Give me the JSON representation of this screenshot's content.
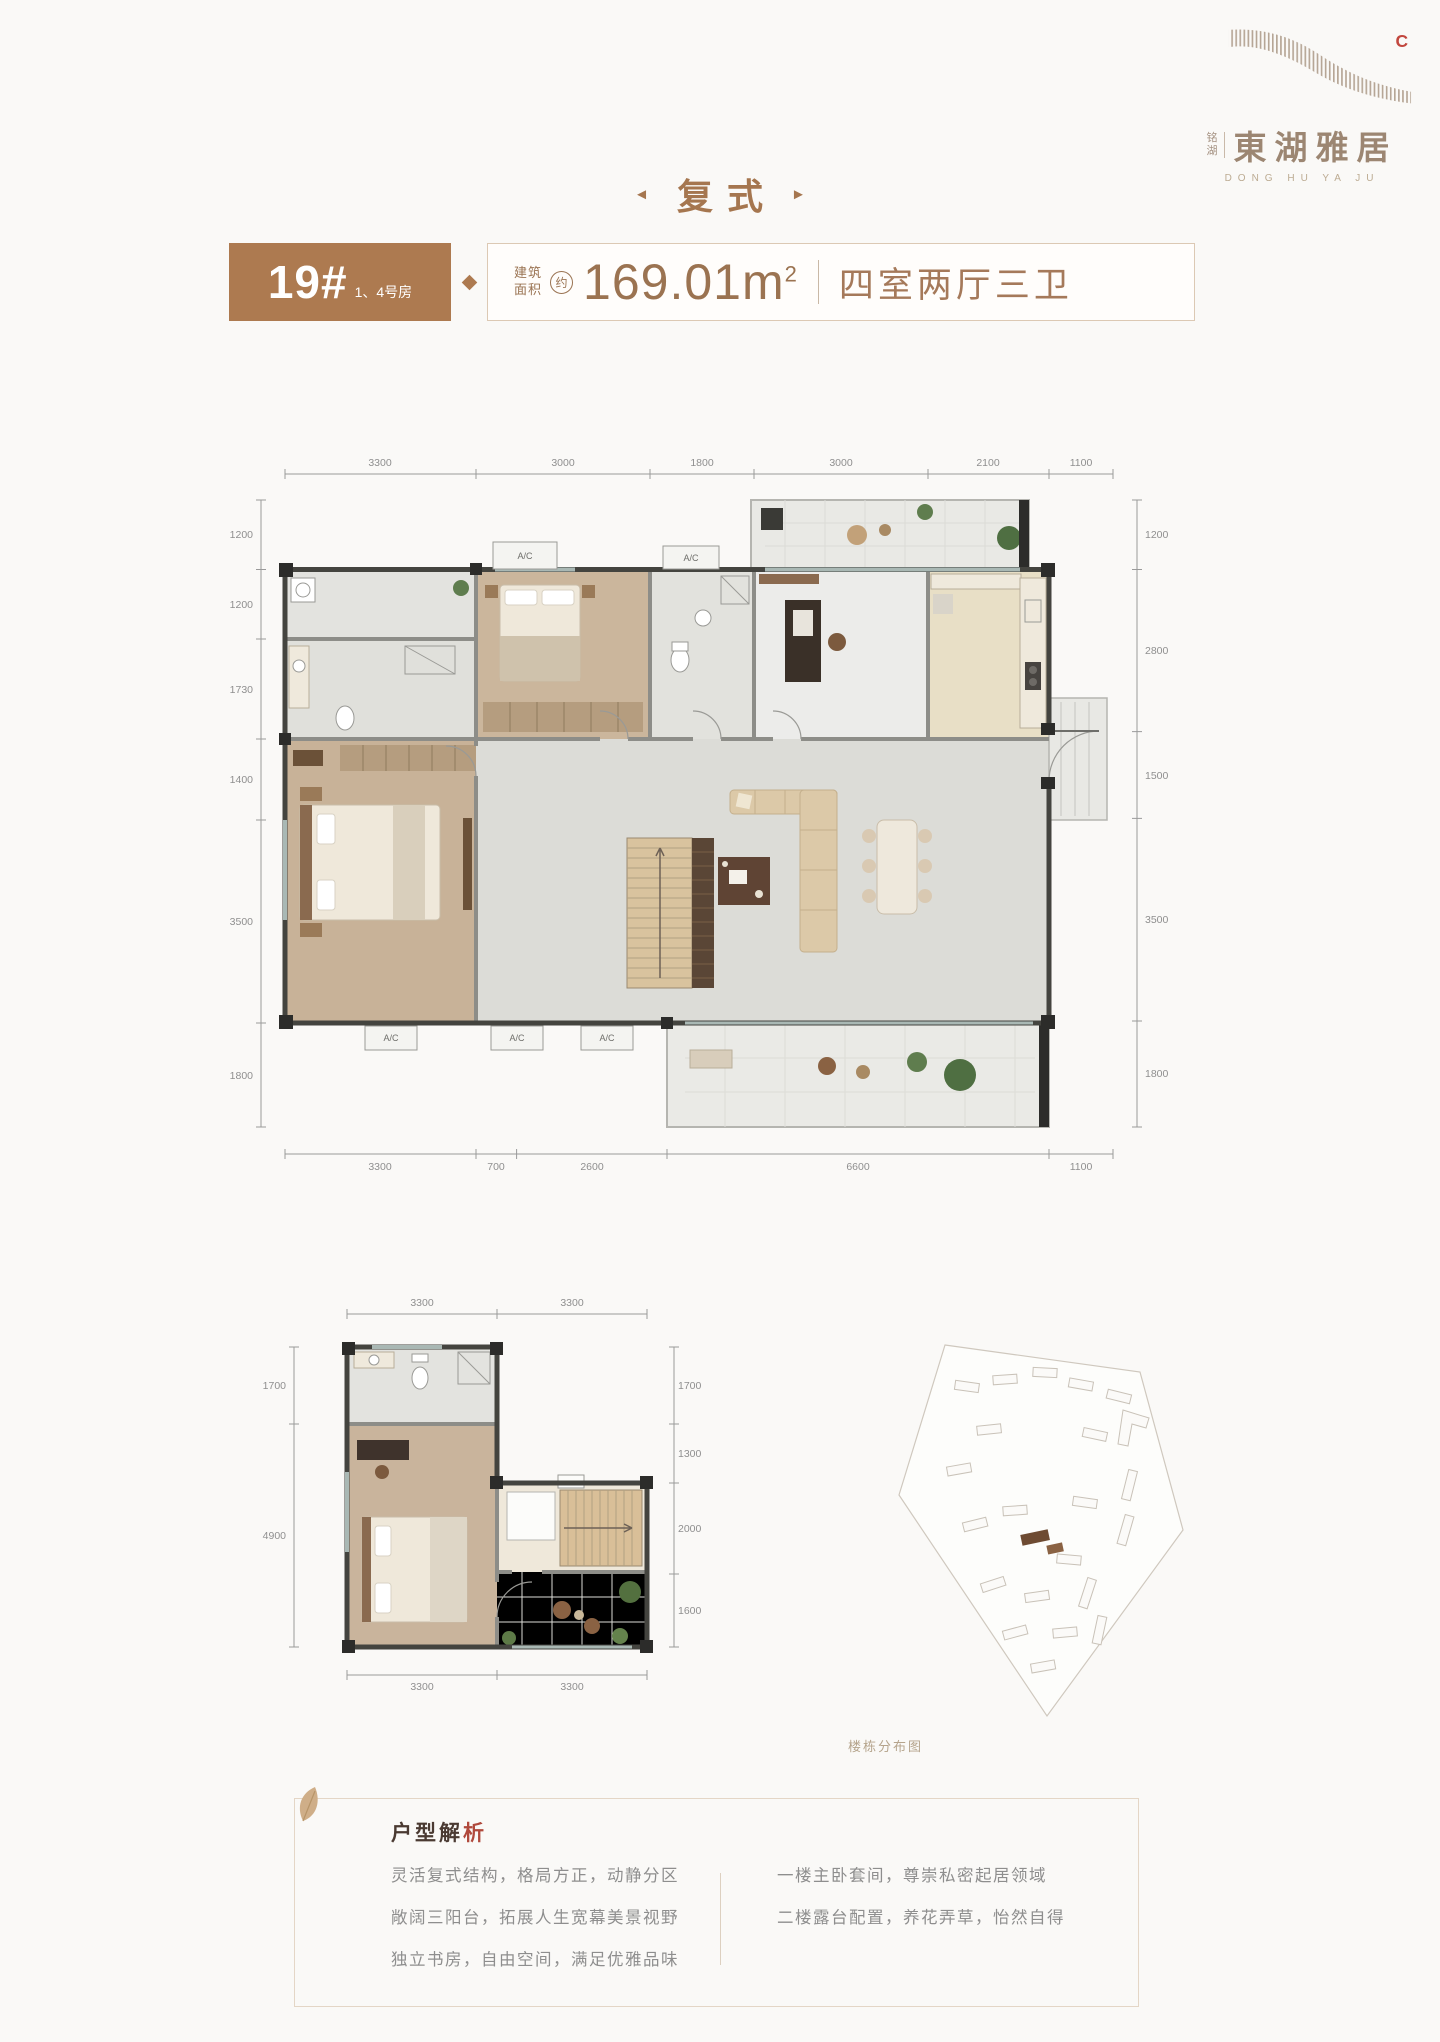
{
  "logo": {
    "mark_letter": "C",
    "brand_small_1": "铭",
    "brand_small_2": "湖",
    "brand_name": "東湖雅居",
    "brand_en": "DONG HU YA JU"
  },
  "section": {
    "title": "复式",
    "left_marker": "◄",
    "right_marker": "►"
  },
  "header": {
    "block_no": "19#",
    "room_no": "1、4号房",
    "area_label_line1": "建筑",
    "area_label_line2": "面积",
    "area_approx": "约",
    "area_value": "169.01m",
    "area_unit_sup": "2",
    "layout": "四室两厅三卫"
  },
  "floor1": {
    "dims_top": [
      "3300",
      "3000",
      "1800",
      "3000",
      "2100",
      "1100"
    ],
    "dims_left": [
      "1200",
      "1200",
      "1730",
      "1400",
      "3500",
      "1800"
    ],
    "dims_right": [
      "1200",
      "2800",
      "1500",
      "3500",
      "1800"
    ],
    "dims_bottom": [
      "3300",
      "700",
      "2600",
      "6600",
      "1100"
    ],
    "ac_label": "A/C"
  },
  "floor2": {
    "dims_top": [
      "3300",
      "3300"
    ],
    "dims_left": [
      "1700",
      "4900"
    ],
    "dims_right": [
      "1700",
      "1300",
      "2000",
      "1600"
    ],
    "dims_bottom": [
      "3300",
      "3300"
    ]
  },
  "siteplan": {
    "caption": "楼栋分布图"
  },
  "analysis": {
    "title_main": "户型解",
    "title_accent": "析",
    "left_lines": [
      "灵活复式结构，格局方正，动静分区",
      "敞阔三阳台，拓展人生宽幕美景视野",
      "独立书房，自由空间，满足优雅品味"
    ],
    "right_lines": [
      "一楼主卧套间，尊崇私密起居领域",
      "二楼露台配置，养花弄草，怡然自得"
    ]
  },
  "colors": {
    "brand_brown": "#ad7a50",
    "text_brown": "#9b7351",
    "accent_red": "#c2473e"
  }
}
